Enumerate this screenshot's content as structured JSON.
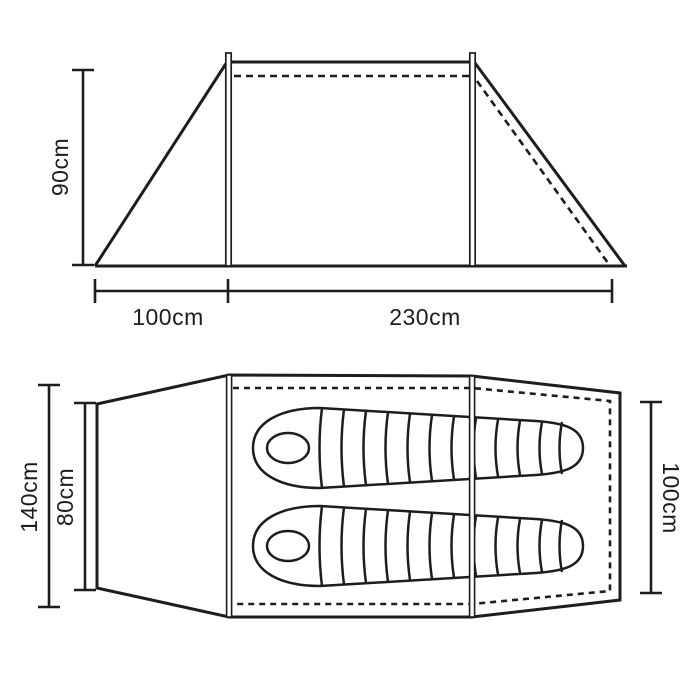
{
  "diagram": {
    "title": "tent-dimensions-diagram",
    "side_view": {
      "pole_height_label": "90cm",
      "porch_length_label": "100cm",
      "sleeping_area_length_label": "230cm"
    },
    "floor_plan": {
      "outer_width_label": "140cm",
      "entrance_width_label": "80cm",
      "inner_length_label": "100cm",
      "sleeping_bag_count": "2"
    },
    "colors": {
      "line": "#1d1d1d",
      "background": "#ffffff",
      "text": "#1d1d1d"
    }
  }
}
